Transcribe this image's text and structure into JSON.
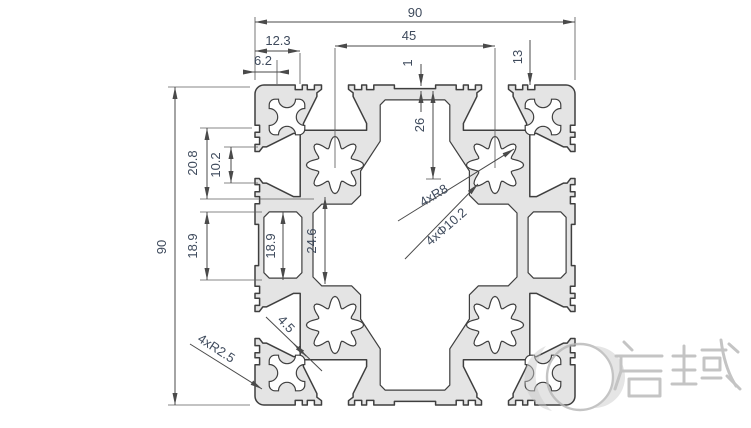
{
  "drawing": {
    "dim_texts": {
      "w90_top": "90",
      "d12_3": "12.3",
      "d6_2": "6.2",
      "d45": "45",
      "d1": "1",
      "d13": "13",
      "d26": "26",
      "h90_left": "90",
      "d20_8": "20.8",
      "d10_2": "10.2",
      "d18_9_outer": "18.9",
      "d18_9_inner": "18.9",
      "d24_6": "24.6",
      "r8": "4xR8",
      "phi10_2": "4xΦ10.2",
      "d4_5": "4.5",
      "r2_5": "4xR2.5"
    },
    "colors": {
      "metal": "#e4e4e4",
      "outline": "#3f3f3f",
      "dim_line": "#4a4a4a",
      "ext_line": "#5f5f5f",
      "dim_text": "#3e4a5c",
      "watermark": "#b6b6b6",
      "background": "#ffffff"
    }
  },
  "watermark": {
    "text": "启域"
  }
}
